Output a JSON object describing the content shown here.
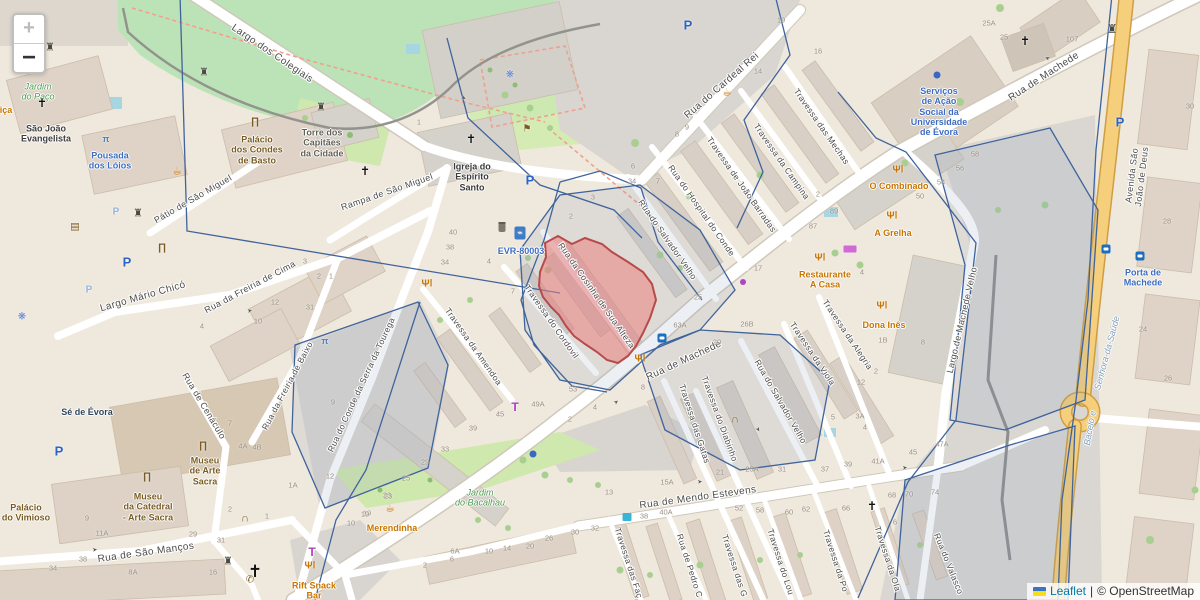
{
  "controls": {
    "zoom_in_label": "+",
    "zoom_out_label": "−"
  },
  "attribution": {
    "leaflet_link": "Leaflet",
    "separator": "|",
    "copyright_text": "© OpenStreetMap"
  },
  "highlight": {
    "name": "Rua da Cosinha de Sua Alteza block",
    "fill": "rgba(235,128,128,0.55)",
    "stroke": "#b84a4a"
  },
  "colors": {
    "boundary": "#3f639c",
    "road_fill": "#ffffff",
    "avenue_fill": "#f6cf7c",
    "park": "#bce3b7",
    "accent_blue": "#3d6cc0",
    "poi_orange": "#c77400"
  },
  "streets": [
    {
      "text": "Largo dos Colegiais",
      "x": 272,
      "y": 54,
      "rot": 34,
      "size": 10
    },
    {
      "text": "Rua do Cardeal Rei",
      "x": 722,
      "y": 86,
      "rot": -41,
      "size": 10
    },
    {
      "text": "Rua de Machede",
      "x": 1044,
      "y": 77,
      "rot": -33,
      "size": 10
    },
    {
      "text": "Rua de Machede",
      "x": 684,
      "y": 361,
      "rot": -25,
      "size": 10
    },
    {
      "text": "Travessa das Mechas",
      "x": 821,
      "y": 127,
      "rot": 55,
      "size": 8.5
    },
    {
      "text": "Travessa da Campina",
      "x": 781,
      "y": 162,
      "rot": 55,
      "size": 8.5
    },
    {
      "text": "Travessa de João Barradas",
      "x": 741,
      "y": 185,
      "rot": 55,
      "size": 8.5
    },
    {
      "text": "Rua do Hospital do Conde",
      "x": 701,
      "y": 211,
      "rot": 55,
      "size": 8.5
    },
    {
      "text": "Rua do Salvador Velho",
      "x": 667,
      "y": 240,
      "rot": 55,
      "size": 8.5
    },
    {
      "text": "Rua da Cosinha de Sua Alteza",
      "x": 596,
      "y": 296,
      "rot": 55,
      "size": 8.5
    },
    {
      "text": "Travessa do Cordovil",
      "x": 551,
      "y": 322,
      "rot": 55,
      "size": 8.5
    },
    {
      "text": "Travessa da Amendoa",
      "x": 473,
      "y": 347,
      "rot": 55,
      "size": 8.5
    },
    {
      "text": "Rampa de São Miguel",
      "x": 387,
      "y": 192,
      "rot": -19,
      "size": 9
    },
    {
      "text": "Pátio de São Miguel",
      "x": 193,
      "y": 199,
      "rot": -30,
      "size": 9
    },
    {
      "text": "Largo Mário Chicó",
      "x": 143,
      "y": 297,
      "rot": -16,
      "size": 10
    },
    {
      "text": "Rua da Freiria de Cima",
      "x": 250,
      "y": 287,
      "rot": -28,
      "size": 9
    },
    {
      "text": "Rua da Freiria de Baixo",
      "x": 288,
      "y": 386,
      "rot": -62,
      "size": 8.5
    },
    {
      "text": "Rua de Cenáculo",
      "x": 204,
      "y": 406,
      "rot": 59,
      "size": 9
    },
    {
      "text": "Rua de São Manços",
      "x": 146,
      "y": 553,
      "rot": -8,
      "size": 10
    },
    {
      "text": "Rua do Conde da Serra da Tourega",
      "x": 362,
      "y": 385,
      "rot": -65,
      "size": 8.5
    },
    {
      "text": "Rua de Mendo Estevens",
      "x": 698,
      "y": 498,
      "rot": -8,
      "size": 10
    },
    {
      "text": "Travessa das Gatas",
      "x": 694,
      "y": 424,
      "rot": 72,
      "size": 8.5
    },
    {
      "text": "Travessa do Diabinho",
      "x": 719,
      "y": 419,
      "rot": 70,
      "size": 8.5
    },
    {
      "text": "Rua do Salvador Velho",
      "x": 780,
      "y": 402,
      "rot": 60,
      "size": 8.5
    },
    {
      "text": "Travessa da Viola",
      "x": 812,
      "y": 354,
      "rot": 56,
      "size": 8.5
    },
    {
      "text": "Travessa da Alegria",
      "x": 847,
      "y": 335,
      "rot": 56,
      "size": 8.5
    },
    {
      "text": "Largo de Machede Velho",
      "x": 962,
      "y": 320,
      "rot": -77,
      "size": 9
    },
    {
      "text": "Avenida São João de Deus",
      "x": 1137,
      "y": 176,
      "rot": -83,
      "size": 9
    },
    {
      "text": "Travessa das Faç",
      "x": 628,
      "y": 563,
      "rot": 72,
      "size": 8.5
    },
    {
      "text": "Rua de Pedro C",
      "x": 689,
      "y": 566,
      "rot": 72,
      "size": 8.5
    },
    {
      "text": "Travessa das G",
      "x": 734,
      "y": 566,
      "rot": 72,
      "size": 8.5
    },
    {
      "text": "Travessa do Lou",
      "x": 780,
      "y": 562,
      "rot": 72,
      "size": 8.5
    },
    {
      "text": "Travessa da Po",
      "x": 835,
      "y": 561,
      "rot": 72,
      "size": 8.5
    },
    {
      "text": "Travessa da Ola",
      "x": 887,
      "y": 559,
      "rot": 72,
      "size": 8.5
    },
    {
      "text": "Rua do Valasco",
      "x": 948,
      "y": 564,
      "rot": 68,
      "size": 8.5
    }
  ],
  "places": [
    {
      "text": "Jardim\ndo Paço",
      "x": 38,
      "y": 92,
      "color": "#4e9a4e",
      "italic": true
    },
    {
      "text": "São João\nEvangelista",
      "x": 46,
      "y": 134,
      "color": "#3d3d3d"
    },
    {
      "text": "Pousada\ndos Lóios",
      "x": 110,
      "y": 161,
      "color": "#3d6cc0"
    },
    {
      "text": "Palácio\ndos Condes\nde Basto",
      "x": 257,
      "y": 150,
      "color": "#7a5c21"
    },
    {
      "text": "Torre dos\nCapitães\nda Cidade",
      "x": 322,
      "y": 143,
      "color": "#636055"
    },
    {
      "text": "Igreja do\nEspírito\nSanto",
      "x": 472,
      "y": 177,
      "color": "#3a3a3a"
    },
    {
      "text": "Serviços\nde Ação\nSocial da\nUniversidade\nde Évora",
      "x": 939,
      "y": 112,
      "color": "#3d6cc0"
    },
    {
      "text": "O Combinado",
      "x": 899,
      "y": 186,
      "color": "#c77400"
    },
    {
      "text": "A Grelha",
      "x": 893,
      "y": 233,
      "color": "#c77400"
    },
    {
      "text": "Restaurante\nA Casa",
      "x": 825,
      "y": 280,
      "color": "#c77400"
    },
    {
      "text": "Dona Inês",
      "x": 884,
      "y": 325,
      "color": "#c77400"
    },
    {
      "text": "EVR-80003",
      "x": 521,
      "y": 251,
      "color": "#3d6cc0"
    },
    {
      "text": "Porta de\nMachede",
      "x": 1143,
      "y": 278,
      "color": "#3d6cc0"
    },
    {
      "text": "Sé de Évora",
      "x": 87,
      "y": 412,
      "color": "#30455c"
    },
    {
      "text": "Palácio\ndo Vimioso",
      "x": 26,
      "y": 513,
      "color": "#7a5c21"
    },
    {
      "text": "Museu\nde Arte\nSacra",
      "x": 205,
      "y": 471,
      "color": "#7a5c21"
    },
    {
      "text": "Museu\nda Catedral\n- Arte Sacra",
      "x": 148,
      "y": 507,
      "color": "#7a5c21"
    },
    {
      "text": "Merendinha",
      "x": 392,
      "y": 528,
      "color": "#c77400"
    },
    {
      "text": "Rift Snack\nBar",
      "x": 314,
      "y": 591,
      "color": "#c77400"
    },
    {
      "text": "Jardim\ndo Bacalhau",
      "x": 480,
      "y": 498,
      "color": "#4e9a4e",
      "italic": true
    },
    {
      "text": "Senhora-da-Saúde",
      "x": 1107,
      "y": 353,
      "color": "#7f9eb8",
      "rot": -75,
      "italic": true
    },
    {
      "text": "Bacelo e",
      "x": 1090,
      "y": 428,
      "color": "#7f9eb8",
      "rot": -80,
      "italic": true
    },
    {
      "text": "iça",
      "x": 6,
      "y": 110,
      "color": "#c77400"
    }
  ],
  "house_numbers": [
    {
      "t": "25A",
      "x": 989,
      "y": 24
    },
    {
      "t": "25",
      "x": 1004,
      "y": 38
    },
    {
      "t": "107",
      "x": 1072,
      "y": 40
    },
    {
      "t": "19",
      "x": 781,
      "y": 21
    },
    {
      "t": "16",
      "x": 818,
      "y": 52
    },
    {
      "t": "14",
      "x": 758,
      "y": 72
    },
    {
      "t": "3",
      "x": 593,
      "y": 198
    },
    {
      "t": "2",
      "x": 571,
      "y": 217
    },
    {
      "t": "1",
      "x": 419,
      "y": 123
    },
    {
      "t": "40",
      "x": 453,
      "y": 233
    },
    {
      "t": "38",
      "x": 450,
      "y": 248
    },
    {
      "t": "34",
      "x": 445,
      "y": 263
    },
    {
      "t": "4",
      "x": 489,
      "y": 262
    },
    {
      "t": "7",
      "x": 513,
      "y": 292
    },
    {
      "t": "2",
      "x": 818,
      "y": 195
    },
    {
      "t": "6",
      "x": 633,
      "y": 167
    },
    {
      "t": "34",
      "x": 632,
      "y": 182
    },
    {
      "t": "7",
      "x": 658,
      "y": 182
    },
    {
      "t": "8",
      "x": 677,
      "y": 135
    },
    {
      "t": "9",
      "x": 687,
      "y": 128
    },
    {
      "t": "89",
      "x": 834,
      "y": 212
    },
    {
      "t": "87",
      "x": 813,
      "y": 227
    },
    {
      "t": "17",
      "x": 758,
      "y": 269
    },
    {
      "t": "25",
      "x": 698,
      "y": 298
    },
    {
      "t": "58",
      "x": 975,
      "y": 155
    },
    {
      "t": "56",
      "x": 960,
      "y": 169
    },
    {
      "t": "54",
      "x": 941,
      "y": 183
    },
    {
      "t": "50",
      "x": 920,
      "y": 197
    },
    {
      "t": "30",
      "x": 1190,
      "y": 107
    },
    {
      "t": "28",
      "x": 1167,
      "y": 222
    },
    {
      "t": "24",
      "x": 1143,
      "y": 330
    },
    {
      "t": "26",
      "x": 1168,
      "y": 379
    },
    {
      "t": "8",
      "x": 923,
      "y": 343
    },
    {
      "t": "4",
      "x": 862,
      "y": 273
    },
    {
      "t": "1B",
      "x": 883,
      "y": 341
    },
    {
      "t": "12",
      "x": 861,
      "y": 383
    },
    {
      "t": "2",
      "x": 876,
      "y": 372
    },
    {
      "t": "63A",
      "x": 680,
      "y": 326
    },
    {
      "t": "26B",
      "x": 747,
      "y": 325
    },
    {
      "t": "20",
      "x": 717,
      "y": 343
    },
    {
      "t": "53",
      "x": 573,
      "y": 390
    },
    {
      "t": "4",
      "x": 595,
      "y": 408
    },
    {
      "t": "2",
      "x": 570,
      "y": 420
    },
    {
      "t": "8",
      "x": 643,
      "y": 388
    },
    {
      "t": "3A",
      "x": 860,
      "y": 417
    },
    {
      "t": "4",
      "x": 865,
      "y": 428
    },
    {
      "t": "5",
      "x": 833,
      "y": 418
    },
    {
      "t": "47A",
      "x": 942,
      "y": 445
    },
    {
      "t": "45",
      "x": 913,
      "y": 453
    },
    {
      "t": "41A",
      "x": 878,
      "y": 462
    },
    {
      "t": "39",
      "x": 848,
      "y": 465
    },
    {
      "t": "37",
      "x": 825,
      "y": 470
    },
    {
      "t": "31",
      "x": 782,
      "y": 470
    },
    {
      "t": "25A",
      "x": 752,
      "y": 470
    },
    {
      "t": "21",
      "x": 720,
      "y": 473
    },
    {
      "t": "49A",
      "x": 538,
      "y": 405
    },
    {
      "t": "45",
      "x": 500,
      "y": 415
    },
    {
      "t": "39",
      "x": 473,
      "y": 429
    },
    {
      "t": "33",
      "x": 445,
      "y": 450
    },
    {
      "t": "29",
      "x": 425,
      "y": 463
    },
    {
      "t": "25",
      "x": 406,
      "y": 479
    },
    {
      "t": "23",
      "x": 387,
      "y": 496
    },
    {
      "t": "19",
      "x": 367,
      "y": 514
    },
    {
      "t": "13",
      "x": 609,
      "y": 493
    },
    {
      "t": "15A",
      "x": 667,
      "y": 483
    },
    {
      "t": "38",
      "x": 644,
      "y": 517
    },
    {
      "t": "40A",
      "x": 666,
      "y": 513
    },
    {
      "t": "52",
      "x": 739,
      "y": 509
    },
    {
      "t": "58",
      "x": 760,
      "y": 511
    },
    {
      "t": "60",
      "x": 789,
      "y": 513
    },
    {
      "t": "62",
      "x": 806,
      "y": 510
    },
    {
      "t": "66",
      "x": 846,
      "y": 509
    },
    {
      "t": "68",
      "x": 892,
      "y": 496
    },
    {
      "t": "70",
      "x": 909,
      "y": 495
    },
    {
      "t": "74",
      "x": 935,
      "y": 493
    },
    {
      "t": "6",
      "x": 895,
      "y": 523
    },
    {
      "t": "30",
      "x": 575,
      "y": 533
    },
    {
      "t": "32",
      "x": 595,
      "y": 529
    },
    {
      "t": "26",
      "x": 549,
      "y": 539
    },
    {
      "t": "20",
      "x": 530,
      "y": 547
    },
    {
      "t": "14",
      "x": 507,
      "y": 549
    },
    {
      "t": "10",
      "x": 489,
      "y": 552
    },
    {
      "t": "6A",
      "x": 455,
      "y": 552
    },
    {
      "t": "6",
      "x": 452,
      "y": 560
    },
    {
      "t": "2",
      "x": 425,
      "y": 566
    },
    {
      "t": "4A",
      "x": 243,
      "y": 447
    },
    {
      "t": "4B",
      "x": 257,
      "y": 448
    },
    {
      "t": "9",
      "x": 333,
      "y": 403
    },
    {
      "t": "12",
      "x": 330,
      "y": 477
    },
    {
      "t": "1A",
      "x": 293,
      "y": 486
    },
    {
      "t": "10",
      "x": 351,
      "y": 524
    },
    {
      "t": "23",
      "x": 388,
      "y": 497
    },
    {
      "t": "19",
      "x": 365,
      "y": 515
    },
    {
      "t": "2",
      "x": 230,
      "y": 510
    },
    {
      "t": "1",
      "x": 267,
      "y": 517
    },
    {
      "t": "31",
      "x": 221,
      "y": 541
    },
    {
      "t": "29",
      "x": 193,
      "y": 535
    },
    {
      "t": "16",
      "x": 213,
      "y": 573
    },
    {
      "t": "8A",
      "x": 133,
      "y": 573
    },
    {
      "t": "38",
      "x": 83,
      "y": 560
    },
    {
      "t": "34",
      "x": 53,
      "y": 569
    },
    {
      "t": "11A",
      "x": 102,
      "y": 534
    },
    {
      "t": "9",
      "x": 87,
      "y": 519
    },
    {
      "t": "3",
      "x": 305,
      "y": 262
    },
    {
      "t": "2",
      "x": 319,
      "y": 277
    },
    {
      "t": "1",
      "x": 331,
      "y": 277
    },
    {
      "t": "12",
      "x": 275,
      "y": 303
    },
    {
      "t": "10",
      "x": 258,
      "y": 322
    },
    {
      "t": "31",
      "x": 310,
      "y": 308
    },
    {
      "t": "4",
      "x": 202,
      "y": 327
    },
    {
      "t": "7",
      "x": 230,
      "y": 424
    }
  ],
  "icons": [
    {
      "type": "church",
      "x": 42,
      "y": 104
    },
    {
      "type": "church",
      "x": 471,
      "y": 140
    },
    {
      "type": "church",
      "x": 1025,
      "y": 42
    },
    {
      "type": "church",
      "x": 365,
      "y": 172
    },
    {
      "type": "church",
      "x": 872,
      "y": 507
    },
    {
      "type": "church",
      "x": 255,
      "y": 572,
      "s": 17
    },
    {
      "type": "tower",
      "x": 50,
      "y": 48
    },
    {
      "type": "tower",
      "x": 204,
      "y": 73
    },
    {
      "type": "tower",
      "x": 321,
      "y": 108
    },
    {
      "type": "tower",
      "x": 138,
      "y": 214
    },
    {
      "type": "tower",
      "x": 228,
      "y": 562
    },
    {
      "type": "gate",
      "x": 1112,
      "y": 30
    },
    {
      "type": "museum",
      "x": 255,
      "y": 122
    },
    {
      "type": "museum",
      "x": 162,
      "y": 248
    },
    {
      "type": "museum",
      "x": 203,
      "y": 446
    },
    {
      "type": "museum",
      "x": 147,
      "y": 477
    },
    {
      "type": "book",
      "x": 75,
      "y": 227
    },
    {
      "type": "arch",
      "x": 245,
      "y": 519
    },
    {
      "type": "arch",
      "x": 735,
      "y": 420
    },
    {
      "type": "guidepost",
      "x": 527,
      "y": 129
    },
    {
      "type": "cafe",
      "x": 177,
      "y": 172
    },
    {
      "type": "cafe",
      "x": 727,
      "y": 93
    },
    {
      "type": "cafe",
      "x": 390,
      "y": 509
    },
    {
      "type": "restaurant",
      "x": 898,
      "y": 170
    },
    {
      "type": "restaurant",
      "x": 892,
      "y": 216
    },
    {
      "type": "restaurant",
      "x": 820,
      "y": 258
    },
    {
      "type": "restaurant",
      "x": 882,
      "y": 306
    },
    {
      "type": "restaurant",
      "x": 640,
      "y": 359
    },
    {
      "type": "restaurant",
      "x": 427,
      "y": 284
    },
    {
      "type": "restaurant",
      "x": 310,
      "y": 566
    },
    {
      "type": "clothes",
      "x": 515,
      "y": 408
    },
    {
      "type": "clothes",
      "x": 312,
      "y": 553
    },
    {
      "type": "shopbox",
      "x": 850,
      "y": 249
    },
    {
      "type": "dotp",
      "x": 743,
      "y": 282
    },
    {
      "type": "dotb",
      "x": 533,
      "y": 454
    },
    {
      "type": "dotb",
      "x": 937,
      "y": 75
    },
    {
      "type": "parking",
      "x": 688,
      "y": 26
    },
    {
      "type": "parking",
      "x": 530,
      "y": 181
    },
    {
      "type": "parking",
      "x": 127,
      "y": 263
    },
    {
      "type": "parking",
      "x": 59,
      "y": 452
    },
    {
      "type": "parking",
      "x": 1120,
      "y": 123
    },
    {
      "type": "parkinglt",
      "x": 116,
      "y": 212
    },
    {
      "type": "parkinglt",
      "x": 89,
      "y": 290
    },
    {
      "type": "busstop",
      "x": 662,
      "y": 338
    },
    {
      "type": "busstop",
      "x": 1106,
      "y": 249
    },
    {
      "type": "busstop",
      "x": 1140,
      "y": 256
    },
    {
      "type": "kiosk",
      "x": 627,
      "y": 517
    },
    {
      "type": "charger",
      "x": 520,
      "y": 233
    },
    {
      "type": "basket",
      "x": 502,
      "y": 227
    },
    {
      "type": "phone",
      "x": 250,
      "y": 580
    },
    {
      "type": "fountain",
      "x": 510,
      "y": 75
    },
    {
      "type": "fountain",
      "x": 22,
      "y": 317
    },
    {
      "type": "bench",
      "x": 106,
      "y": 139
    },
    {
      "type": "bench",
      "x": 325,
      "y": 341
    },
    {
      "type": "oneway",
      "x": 463,
      "y": 99,
      "rot": 34
    },
    {
      "type": "oneway",
      "x": 617,
      "y": 403,
      "rot": -38
    },
    {
      "type": "oneway",
      "x": 700,
      "y": 483,
      "rot": -8
    },
    {
      "type": "oneway",
      "x": 905,
      "y": 469,
      "rot": -8
    },
    {
      "type": "oneway",
      "x": 757,
      "y": 430,
      "rot": 60
    },
    {
      "type": "oneway",
      "x": 250,
      "y": 312,
      "rot": -14
    },
    {
      "type": "oneway",
      "x": 95,
      "y": 551,
      "rot": -5
    },
    {
      "type": "oneway",
      "x": 1048,
      "y": 57,
      "rot": -155
    }
  ]
}
